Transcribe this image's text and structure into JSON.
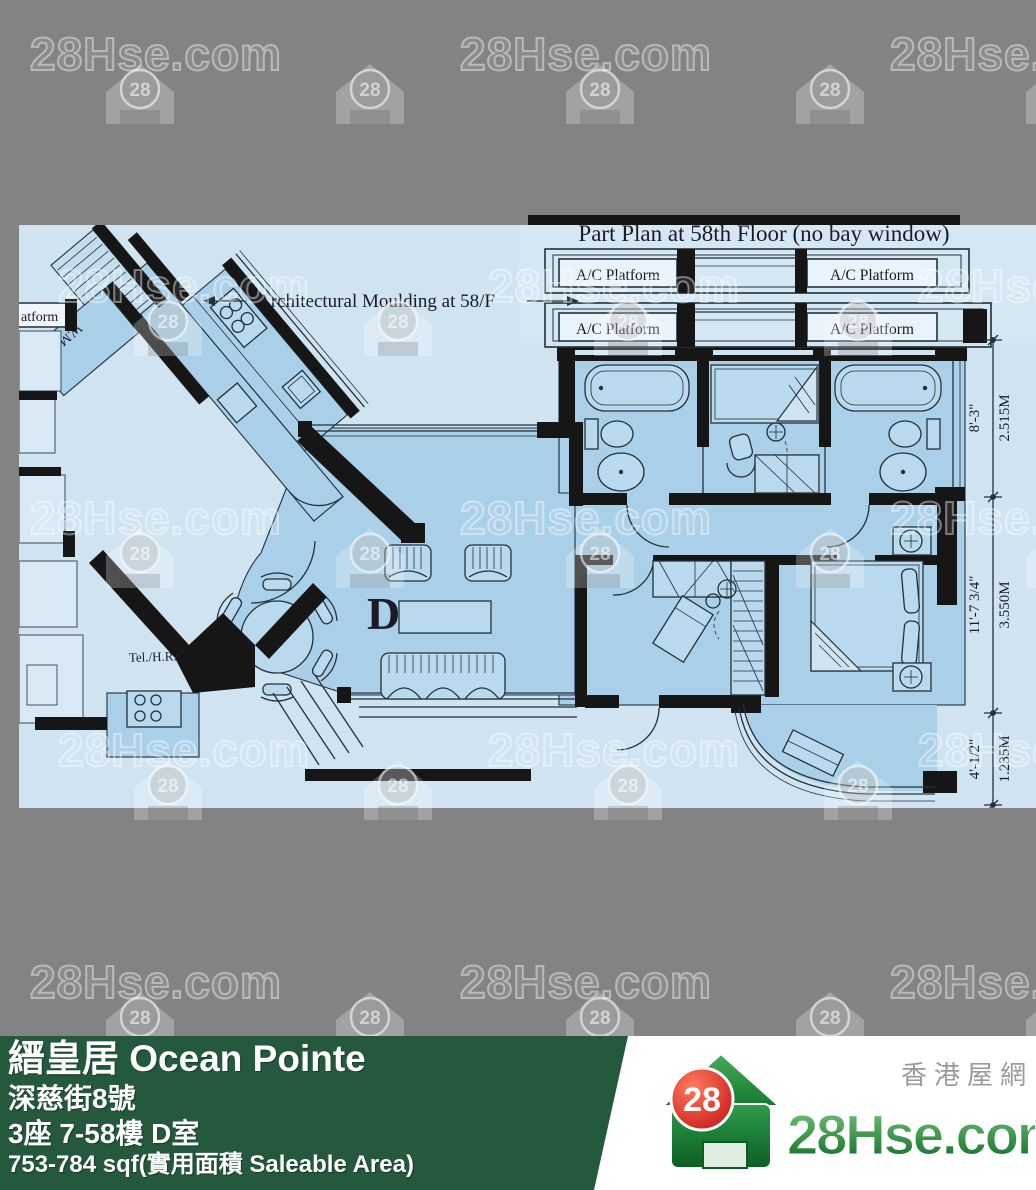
{
  "watermark": {
    "brand": "28Hse.com",
    "badge": "28"
  },
  "plan": {
    "title": "Part Plan at 58th Floor (no bay window)",
    "moulding_note": "Architectural Moulding at 58/F",
    "ac_label": "A/C Platform",
    "platform_partial": "atform",
    "wmr_label": "W.M.R.",
    "tel_label": "Tel./H.R.",
    "unit_letter": "D",
    "dimensions": [
      {
        "feet": "8'-3\"",
        "meters": "2.515M"
      },
      {
        "feet": "11'-7 3/4\"",
        "meters": "3.550M"
      },
      {
        "feet": "4'-1/2\"",
        "meters": "1.235M"
      }
    ],
    "colors": {
      "paper": "#cfe3f1",
      "room": "#a9cfe9",
      "wall": "#161616"
    }
  },
  "footer": {
    "title": "縉皇居 Ocean Pointe",
    "address": "深慈街8號",
    "unit": "3座 7-58樓 D室",
    "area": "753-784 sqf(實用面積 Saleable Area)",
    "panel_color": "#24593d"
  },
  "logo": {
    "brand": "28Hse.com",
    "tagline": "香港屋網",
    "badge": "28",
    "green": "#128a37",
    "red": "#d81f1f"
  }
}
